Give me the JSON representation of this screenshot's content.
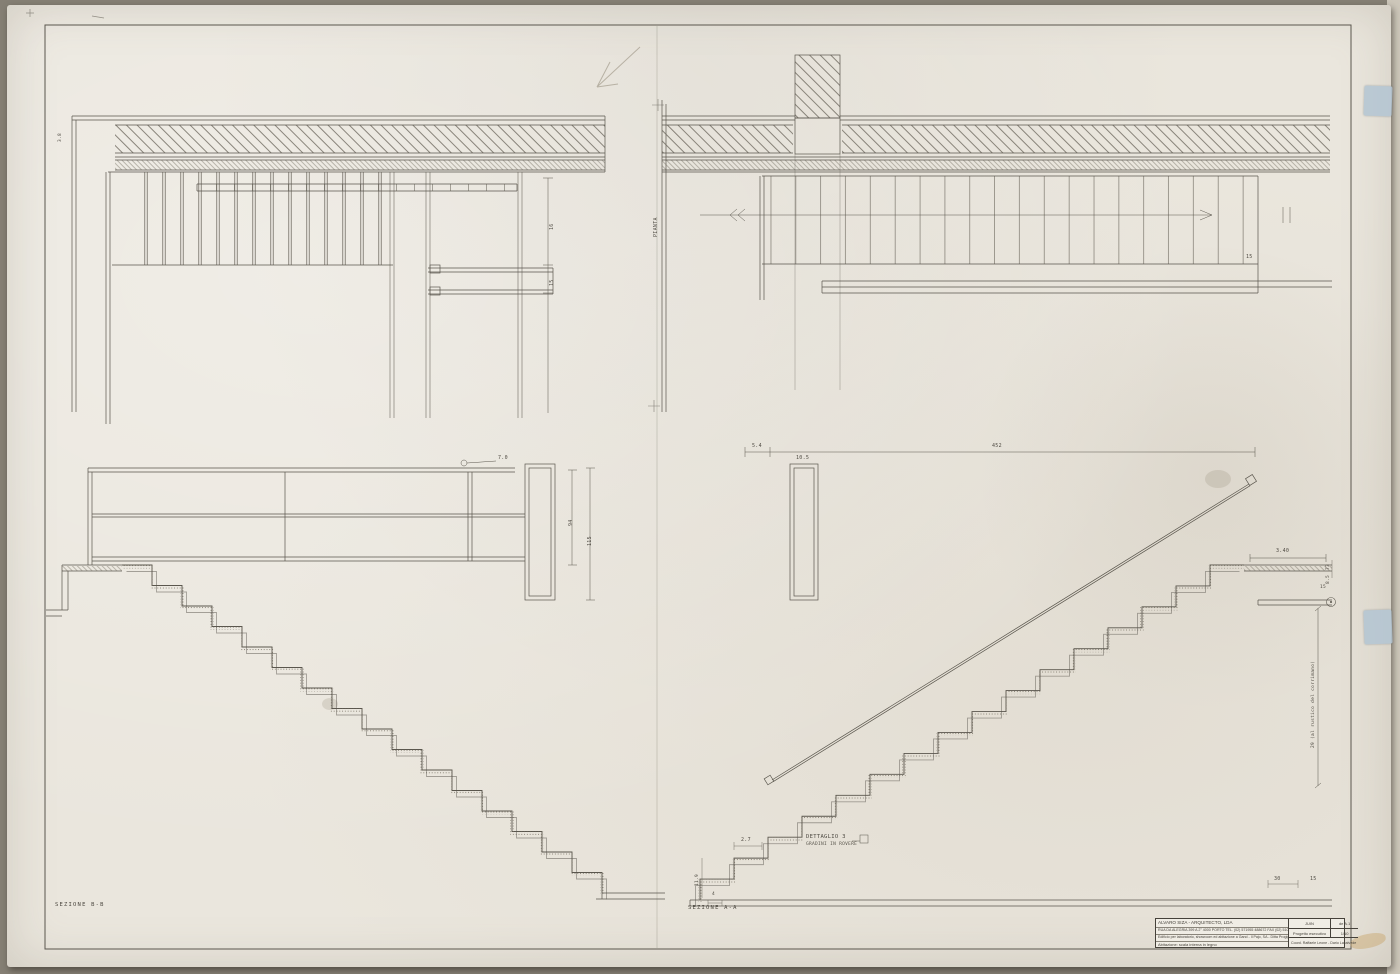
{
  "labels": {
    "pianta": "PIANTA",
    "section_bb": "SEZIONE  B-B",
    "section_aa": "SEZIONE  A-A",
    "dettaglio": "DETTAGLIO 3",
    "dettaglio_sub": "GRADINI IN ROVERE",
    "corner_note": "3.8"
  },
  "dims": {
    "d16": "16",
    "d15a": "15",
    "d70": "7.0",
    "d94": "94",
    "d115": "115",
    "d54": "5.4",
    "d452": "452",
    "d105": "10.5",
    "d15b": "15",
    "d340": "3.40",
    "d73": "73",
    "d85": "8.5",
    "d15c": "15",
    "d27": "2.7",
    "d119": "11.9",
    "d30": "30",
    "d15d": "15",
    "d4": "4",
    "rail_note": "29 (al rustico del corrimano)"
  },
  "title_block": {
    "architect": "ALVARO SIZA  -  ARQUITECTO, LDA",
    "address": "RUA DA ALEGRIA 399 A 2°  4000 PORTO   TEL. (02) 571955 488672   FAX (02) 5102018",
    "project": "Edificio per laboratorio, showroom ed abitazione a Gand - Il Pajo, SA  -  Ditta Progignone 5",
    "drawing_title": "Abitazione: scala interna in legno",
    "date": "JUIN",
    "sheet_no": "de A.1",
    "phase": "Progetto esecutivo",
    "scale": "1/10",
    "credits": "Coord.  Raffaele Leone - Dario Lacalvede"
  },
  "colors": {
    "paper": "#eae6dd",
    "ink": "#56524a",
    "tape": "#b3c5d3"
  }
}
